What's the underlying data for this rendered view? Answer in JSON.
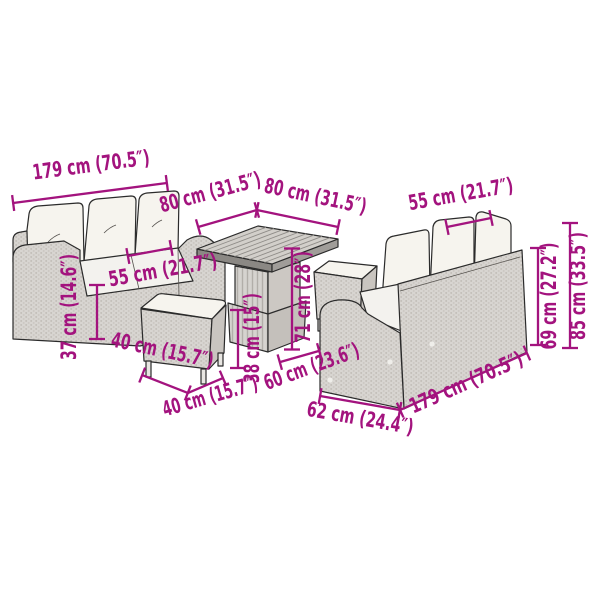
{
  "scene": {
    "description": "Garden furniture set dimension diagram",
    "items": [
      "three-seat wicker sofa (left)",
      "square slatted-top table (center)",
      "cube stool (front)",
      "cube stool (behind table)",
      "three-seat wicker sofa (right)"
    ]
  },
  "colors": {
    "dimension": "#A3137E",
    "outline": "#2b2b2b",
    "wicker_light": "#d8d5d1",
    "wicker_shade": "#c6c2bd",
    "cushion": "#f6f4ee",
    "background": "#ffffff"
  },
  "dimensions": [
    {
      "id": "left-sofa-width",
      "label": "179 cm (70.5″)"
    },
    {
      "id": "table-depth",
      "label": "80 cm (31.5″)"
    },
    {
      "id": "table-width",
      "label": "80 cm (31.5″)"
    },
    {
      "id": "left-sofa-seat-depth",
      "label": "55 cm (21.7″)"
    },
    {
      "id": "left-sofa-seat-height",
      "label": "37 cm (14.6″)"
    },
    {
      "id": "stool-top-depth",
      "label": "40 cm (15.7″)"
    },
    {
      "id": "stool-top-width",
      "label": "40 cm (15.7″)"
    },
    {
      "id": "stool-height",
      "label": "38 cm (15″)"
    },
    {
      "id": "table-height",
      "label": "71 cm (28″)"
    },
    {
      "id": "sofa-seat-depth-right",
      "label": "60 cm (23.6″)"
    },
    {
      "id": "right-sofa-depth",
      "label": "62 cm (24.4″)"
    },
    {
      "id": "right-sofa-width",
      "label": "179 cm (70.5″)"
    },
    {
      "id": "right-sofa-seat-width",
      "label": "55 cm (21.7″)"
    },
    {
      "id": "right-sofa-back-height",
      "label": "69 cm (27.2″)"
    },
    {
      "id": "right-sofa-total-height",
      "label": "85 cm (33.5″)"
    }
  ]
}
